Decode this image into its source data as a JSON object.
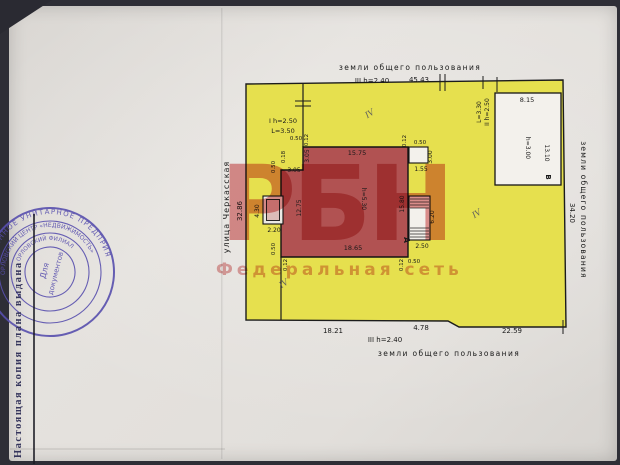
{
  "watermark": {
    "logo": "РБН",
    "subtitle": "Федеральная сеть"
  },
  "stamp": {
    "ring1": "ГОСУДАРСТВЕННОЕ УНИТАРНОЕ ПРЕДПРИЯТИЕ",
    "ring2": "ОРЛОВСКИЙ ЦЕНТР «НЕДВИЖИМОСТЬ»",
    "ring3": "ОРЛОВСКИЙ ФИЛИАЛ",
    "center_line1": "Для",
    "center_line2": "документов",
    "side_note": "Настоящая копия плана выдана"
  },
  "plan": {
    "top": {
      "land": "земли общего пользования",
      "fence": "III h=2.40",
      "len": "45.43"
    },
    "bottom": {
      "d1": "18.21",
      "d2": "4.78",
      "d3": "22.59",
      "fence": "III h=2.40",
      "land": "земли общего пользования"
    },
    "left": {
      "street": "улица Черкасская",
      "len": "32.86"
    },
    "right": {
      "land": "земли общего пользования",
      "len": "34.20"
    },
    "fence1": {
      "l1": "I h=2.50",
      "l2": "L=3.50"
    },
    "fence2": {
      "l1": "II h=2.50",
      "l2": "L=3.30"
    },
    "bldgA": {
      "letter": "А",
      "height": "h=5.30",
      "top": "15.75",
      "bottom": "18.65",
      "left": "12.75",
      "right": "15.80",
      "step_v": "3.05",
      "step_h": "3.05"
    },
    "porch": {
      "w": "2.20",
      "h": "4.30"
    },
    "annex1": {
      "w": "1.55",
      "h": "3.00"
    },
    "annex2": {
      "w": "2.50",
      "h": "6.20"
    },
    "bldgB": {
      "letter": "В",
      "top": "8.15",
      "height": "h=3.00",
      "side": "13.10"
    },
    "off": {
      "o050": "0.50",
      "o012": "0.12",
      "o018": "0.18"
    },
    "hw": "IV"
  }
}
